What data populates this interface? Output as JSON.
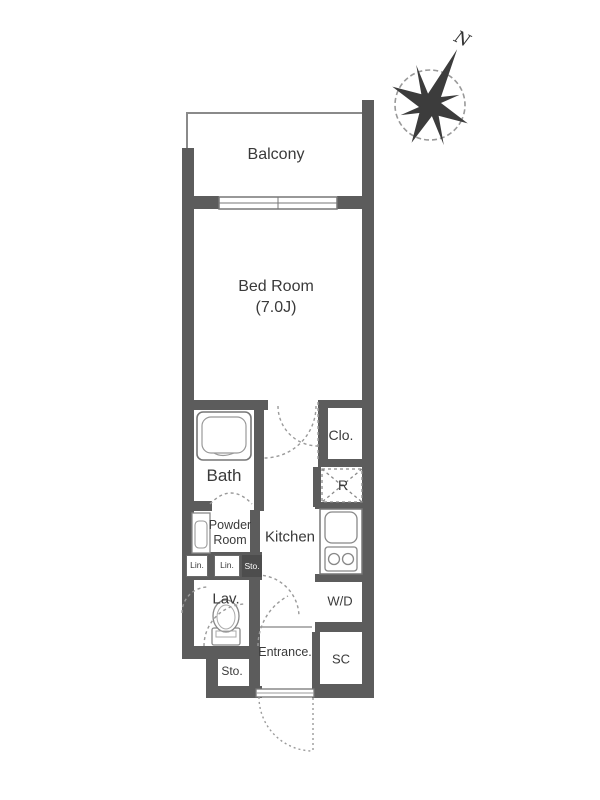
{
  "plan_type": "apartment-floor-plan",
  "rooms": {
    "balcony": {
      "label": "Balcony"
    },
    "bedroom": {
      "label": "Bed Room",
      "size": "(7.0J)"
    },
    "bath": {
      "label": "Bath"
    },
    "closet": {
      "label": "Clo."
    },
    "refrigerator": {
      "label": "R"
    },
    "kitchen": {
      "label": "Kitchen"
    },
    "powder_room": {
      "label": "Powder Room",
      "line1": "Powder",
      "line2": "Room"
    },
    "linen_left": {
      "label": "Lin."
    },
    "linen_mid": {
      "label": "Lin."
    },
    "storage_upper": {
      "label": "Sto."
    },
    "lavatory": {
      "label": "Lav."
    },
    "washer_dryer": {
      "label": "W/D"
    },
    "storage_lower": {
      "label": "Sto."
    },
    "entrance": {
      "label": "Entrance."
    },
    "shoe_closet": {
      "label": "SC"
    }
  },
  "compass": {
    "label": "N"
  },
  "colors": {
    "wall": "#5c5c5c",
    "fixture_line": "#777777",
    "door_dash": "#9a9a9a",
    "text": "#3a3a3a",
    "background": "#ffffff"
  }
}
